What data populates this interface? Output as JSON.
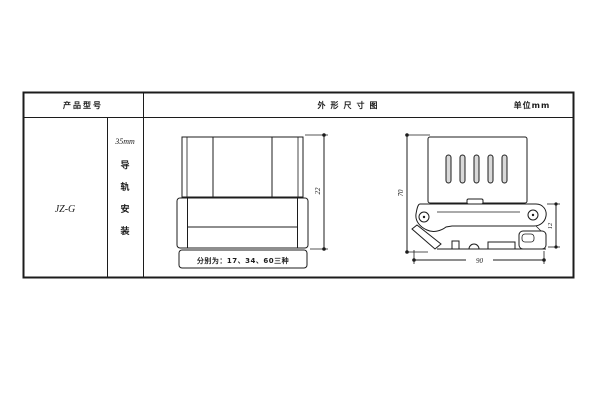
{
  "colors": {
    "line": "#1c1c1c",
    "background": "#ffffff",
    "slot_fill": "#d9d9d9"
  },
  "table": {
    "header": {
      "product_model": "产品型号",
      "outline_title": "外形尺寸图",
      "unit": "单位mm"
    },
    "model": "JZ-G",
    "mount": {
      "rail_size": "35mm",
      "label": "导轨安装",
      "chars": [
        "导",
        "轨",
        "安",
        "装"
      ]
    }
  },
  "front_view": {
    "height_dim": "22",
    "note": "分别为：17、34、60三种"
  },
  "side_view": {
    "height_dim": "70",
    "clip_dim": "12",
    "depth_dim": "90"
  }
}
